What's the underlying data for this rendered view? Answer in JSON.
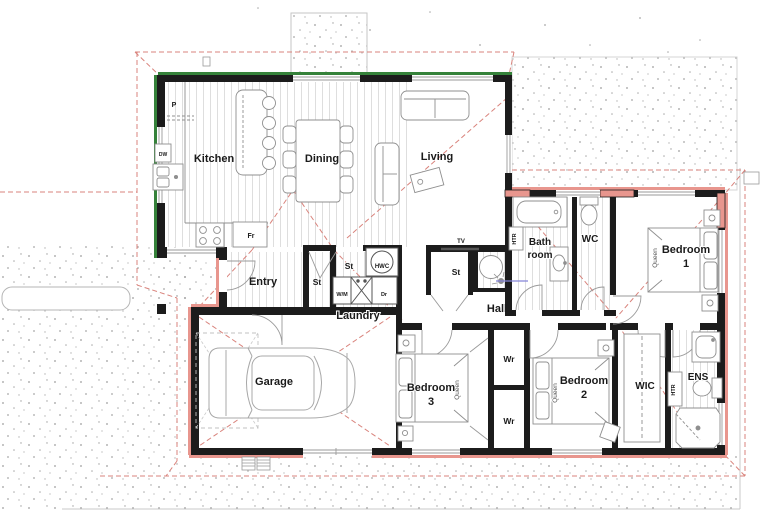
{
  "plan": {
    "room_labels": {
      "kitchen": "Kitchen",
      "dining": "Dining",
      "living": "Living",
      "bathroom_line1": "Bath",
      "bathroom_line2": "room",
      "wc": "WC",
      "bedroom1_line1": "Bedroom",
      "bedroom1_line2": "1",
      "entry": "Entry",
      "laundry": "Laundry",
      "hall": "Hall",
      "garage": "Garage",
      "bedroom3_line1": "Bedroom",
      "bedroom3_line2": "3",
      "bedroom2_line1": "Bedroom",
      "bedroom2_line2": "2",
      "wic": "WIC",
      "ens": "ENS"
    },
    "fixture_labels": {
      "pantry": "P",
      "dishwasher": "DW",
      "fridge": "Fr",
      "storage": "St",
      "hot_water_cylinder": "HWC",
      "washing_machine": "W/M",
      "dryer": "Dr",
      "tv": "TV",
      "heater": "HTR",
      "queen_bed": "Queen",
      "wardrobe": "Wr"
    },
    "colors": {
      "wall": "#1c1c1c",
      "existing_wall_edge_green": "#35823a",
      "new_wall_edge_pink": "#e8968e",
      "roof_overhang_dashed": "#d9837c",
      "plumbing_blue": "#8585d8",
      "floorboard_line": "#dedede",
      "concrete_speckle": "#a3a3a3",
      "fixture_stroke": "#8f8f8f"
    }
  }
}
